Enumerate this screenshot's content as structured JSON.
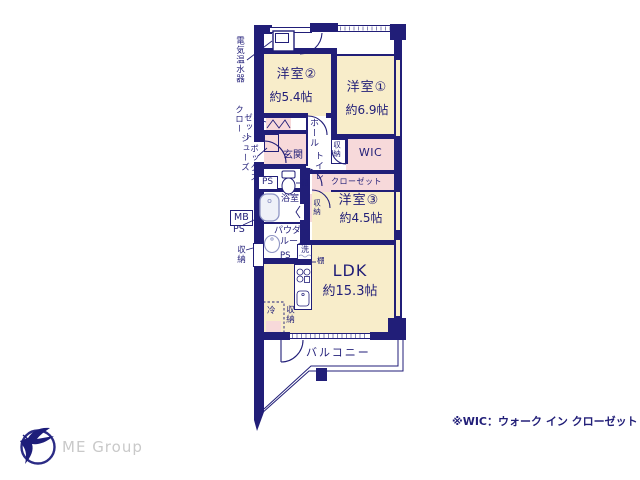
{
  "note": "※WIC：ウォーク イン クローゼット",
  "brand": "ME Group",
  "rooms": {
    "y2": {
      "name": "洋室②",
      "size": "約5.4帖"
    },
    "y1": {
      "name": "洋室①",
      "size": "約6.9帖"
    },
    "y3": {
      "name": "洋室③",
      "size": "約4.5帖"
    },
    "ldk": {
      "name": "LDK",
      "size": "約15.3帖"
    },
    "wic": {
      "name": "WIC"
    },
    "closet": {
      "name": "クローゼット"
    },
    "genkan": {
      "name": "玄関"
    },
    "hall": {
      "name": "ホール"
    },
    "toilet": {
      "name": "トイレ"
    },
    "bath": {
      "name": "浴室"
    },
    "powder": {
      "name": "パウダールーム",
      "line1": "パウダー",
      "line2": "ルーム"
    },
    "balcony": {
      "name": "バルコニー"
    }
  },
  "labels": {
    "water_heater": "電気温水器",
    "closet_col1": "クロー",
    "closet_col2": "ゼット",
    "shoes_col1": "シューズ",
    "shoes_col2": "ボックス",
    "mb": "MB",
    "ps": "PS",
    "storage": "収納",
    "shelf": "棚",
    "fridge": "冷",
    "washer": "洗"
  },
  "colors": {
    "wall": "#211e78",
    "room_floor": "#f8edca",
    "closet_pink": "#f7d9da",
    "fixture": "#8f95c4",
    "logo_text": "#c9c9c9"
  }
}
